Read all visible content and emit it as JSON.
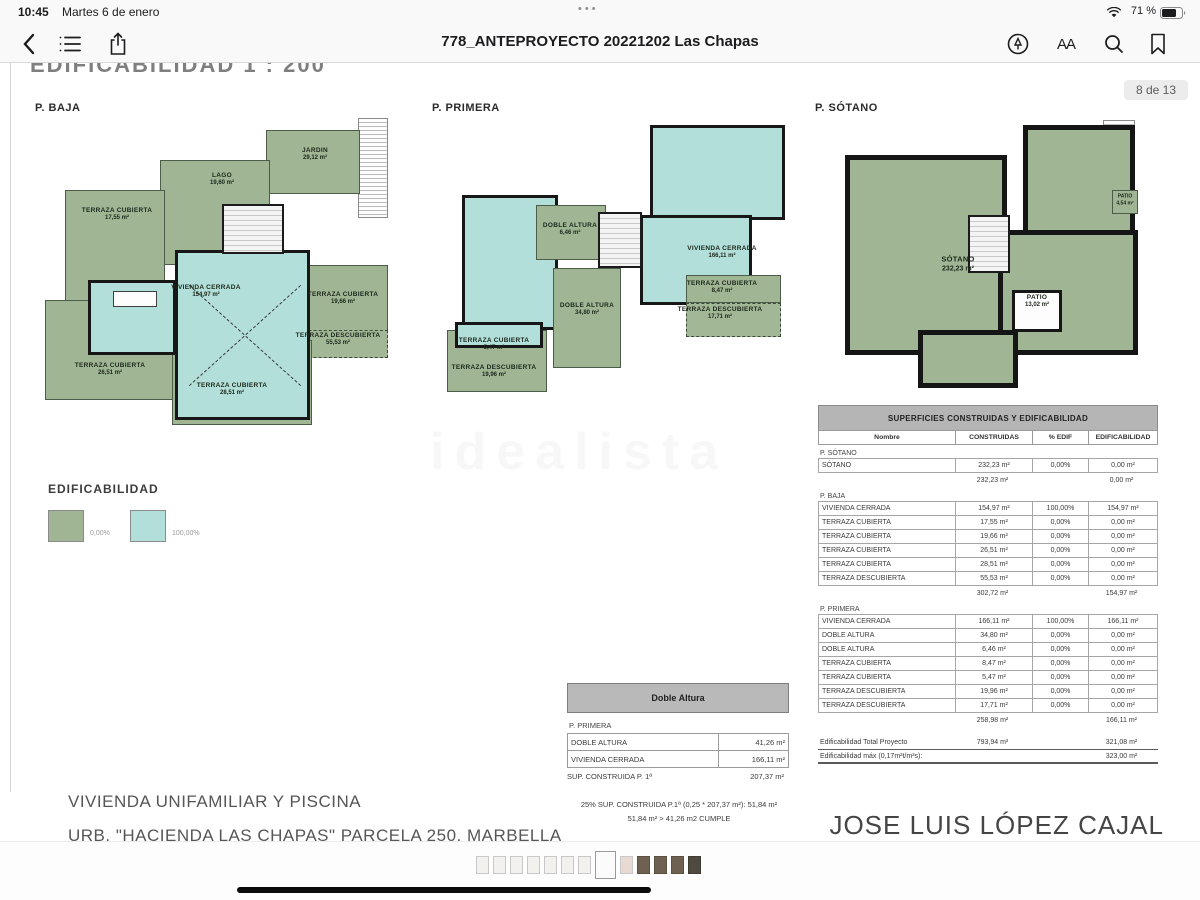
{
  "status_bar": {
    "time": "10:45",
    "date": "Martes 6 de enero",
    "battery": "71 %"
  },
  "nav_bar": {
    "title": "778_ANTEPROYECTO 20221202 Las Chapas",
    "text_size_label": "AA"
  },
  "page": {
    "sheet_title": "EDIFICABILIDAD  1 : 200",
    "page_indicator": "8 de 13",
    "watermark": "idealista",
    "footer_line1": "VIVIENDA UNIFAMILIAR Y PISCINA",
    "footer_line2": "URB. \"HACIENDA LAS CHAPAS\" PARCELA 250, MARBELLA",
    "architect": "JOSE LUIS LÓPEZ CAJAL"
  },
  "legend": {
    "title": "EDIFICABILIDAD",
    "items": [
      {
        "label": "0,00%",
        "color": "#9fb593"
      },
      {
        "label": "100,00%",
        "color": "#b2dfd9"
      }
    ]
  },
  "plans": [
    {
      "label": "P. BAJA",
      "rooms": [
        {
          "name": "JARDIN",
          "area": "29,12 m²"
        },
        {
          "name": "LAGO",
          "area": "19,60 m²"
        },
        {
          "name": "TERRAZA CUBIERTA",
          "area": "17,55 m²"
        },
        {
          "name": "VIVIENDA CERRADA",
          "area": "154,97 m²"
        },
        {
          "name": "TERRAZA CUBIERTA",
          "area": "19,66 m²"
        },
        {
          "name": "TERRAZA DESCUBIERTA",
          "area": "55,53 m²"
        },
        {
          "name": "TERRAZA CUBIERTA",
          "area": "26,51 m²"
        },
        {
          "name": "TERRAZA CUBIERTA",
          "area": "28,51 m²"
        }
      ]
    },
    {
      "label": "P. PRIMERA",
      "rooms": [
        {
          "name": "DOBLE ALTURA",
          "area": "6,46 m²"
        },
        {
          "name": "VIVIENDA CERRADA",
          "area": "166,11 m²"
        },
        {
          "name": "DOBLE ALTURA",
          "area": "34,80 m²"
        },
        {
          "name": "TERRAZA CUBIERTA",
          "area": "8,47 m²"
        },
        {
          "name": "TERRAZA DESCUBIERTA",
          "area": "17,71 m²"
        },
        {
          "name": "TERRAZA CUBIERTA",
          "area": "5,47 m²"
        },
        {
          "name": "TERRAZA DESCUBIERTA",
          "area": "19,96 m²"
        }
      ]
    },
    {
      "label": "P. SÓTANO",
      "rooms": [
        {
          "name": "SÓTANO",
          "area": "232,23 m²"
        },
        {
          "name": "PATIO",
          "area": "13,02 m²"
        },
        {
          "name": "PATIO",
          "area": "4,54 m²"
        }
      ]
    }
  ],
  "main_table": {
    "title": "SUPERFICIES CONSTRUIDAS Y EDIFICABILIDAD",
    "columns": [
      "Nombre",
      "CONSTRUIDAS",
      "% EDIF",
      "EDIFICABILIDAD"
    ],
    "sections": [
      {
        "name": "P. SÓTANO",
        "rows": [
          [
            "SÓTANO",
            "232,23 m²",
            "0,00%",
            "0,00 m²"
          ]
        ],
        "subtotal": {
          "constructed": "232,23 m²",
          "edificability": "0,00 m²"
        }
      },
      {
        "name": "P. BAJA",
        "rows": [
          [
            "VIVIENDA CERRADA",
            "154,97 m²",
            "100,00%",
            "154,97 m²"
          ],
          [
            "TERRAZA CUBIERTA",
            "17,55 m²",
            "0,00%",
            "0,00 m²"
          ],
          [
            "TERRAZA CUBIERTA",
            "19,66 m²",
            "0,00%",
            "0,00 m²"
          ],
          [
            "TERRAZA CUBIERTA",
            "26,51 m²",
            "0,00%",
            "0,00 m²"
          ],
          [
            "TERRAZA CUBIERTA",
            "28,51 m²",
            "0,00%",
            "0,00 m²"
          ],
          [
            "TERRAZA DESCUBIERTA",
            "55,53 m²",
            "0,00%",
            "0,00 m²"
          ]
        ],
        "subtotal": {
          "constructed": "302,72 m²",
          "edificability": "154,97 m²"
        }
      },
      {
        "name": "P. PRIMERA",
        "rows": [
          [
            "VIVIENDA CERRADA",
            "166,11 m²",
            "100,00%",
            "166,11 m²"
          ],
          [
            "DOBLE ALTURA",
            "34,80 m²",
            "0,00%",
            "0,00 m²"
          ],
          [
            "DOBLE ALTURA",
            "6,46 m²",
            "0,00%",
            "0,00 m²"
          ],
          [
            "TERRAZA CUBIERTA",
            "8,47 m²",
            "0,00%",
            "0,00 m²"
          ],
          [
            "TERRAZA CUBIERTA",
            "5,47 m²",
            "0,00%",
            "0,00 m²"
          ],
          [
            "TERRAZA DESCUBIERTA",
            "19,96 m²",
            "0,00%",
            "0,00 m²"
          ],
          [
            "TERRAZA DESCUBIERTA",
            "17,71 m²",
            "0,00%",
            "0,00 m²"
          ]
        ],
        "subtotal": {
          "constructed": "258,98 m²",
          "edificability": "166,11 m²"
        }
      }
    ],
    "totals": [
      {
        "label": "Edificabilidad Total Proyecto",
        "constructed": "793,94 m²",
        "edificability": "321,08 m²"
      },
      {
        "label": "Edificabilidad máx (0,17m²t/m²s):",
        "constructed": "",
        "edificability": "323,00 m²"
      }
    ]
  },
  "doble_altura_table": {
    "title": "Doble Altura",
    "section": "P. PRIMERA",
    "rows": [
      {
        "name": "DOBLE ALTURA",
        "value": "41,26 m²"
      },
      {
        "name": "VIVIENDA CERRADA",
        "value": "166,11 m²"
      }
    ],
    "total_label": "SUP. CONSTRUIDA P. 1ª",
    "total_value": "207,37 m²",
    "note1": "25% SUP. CONSTRUIDA P.1ª (0,25 * 207,37 m²):   51,84 m²",
    "note2": "51,84 m²  >  41,26 m2   CUMPLE"
  },
  "thumbnails": {
    "count": 13,
    "current": 8,
    "warm_page": 9,
    "dark_from": 10
  }
}
